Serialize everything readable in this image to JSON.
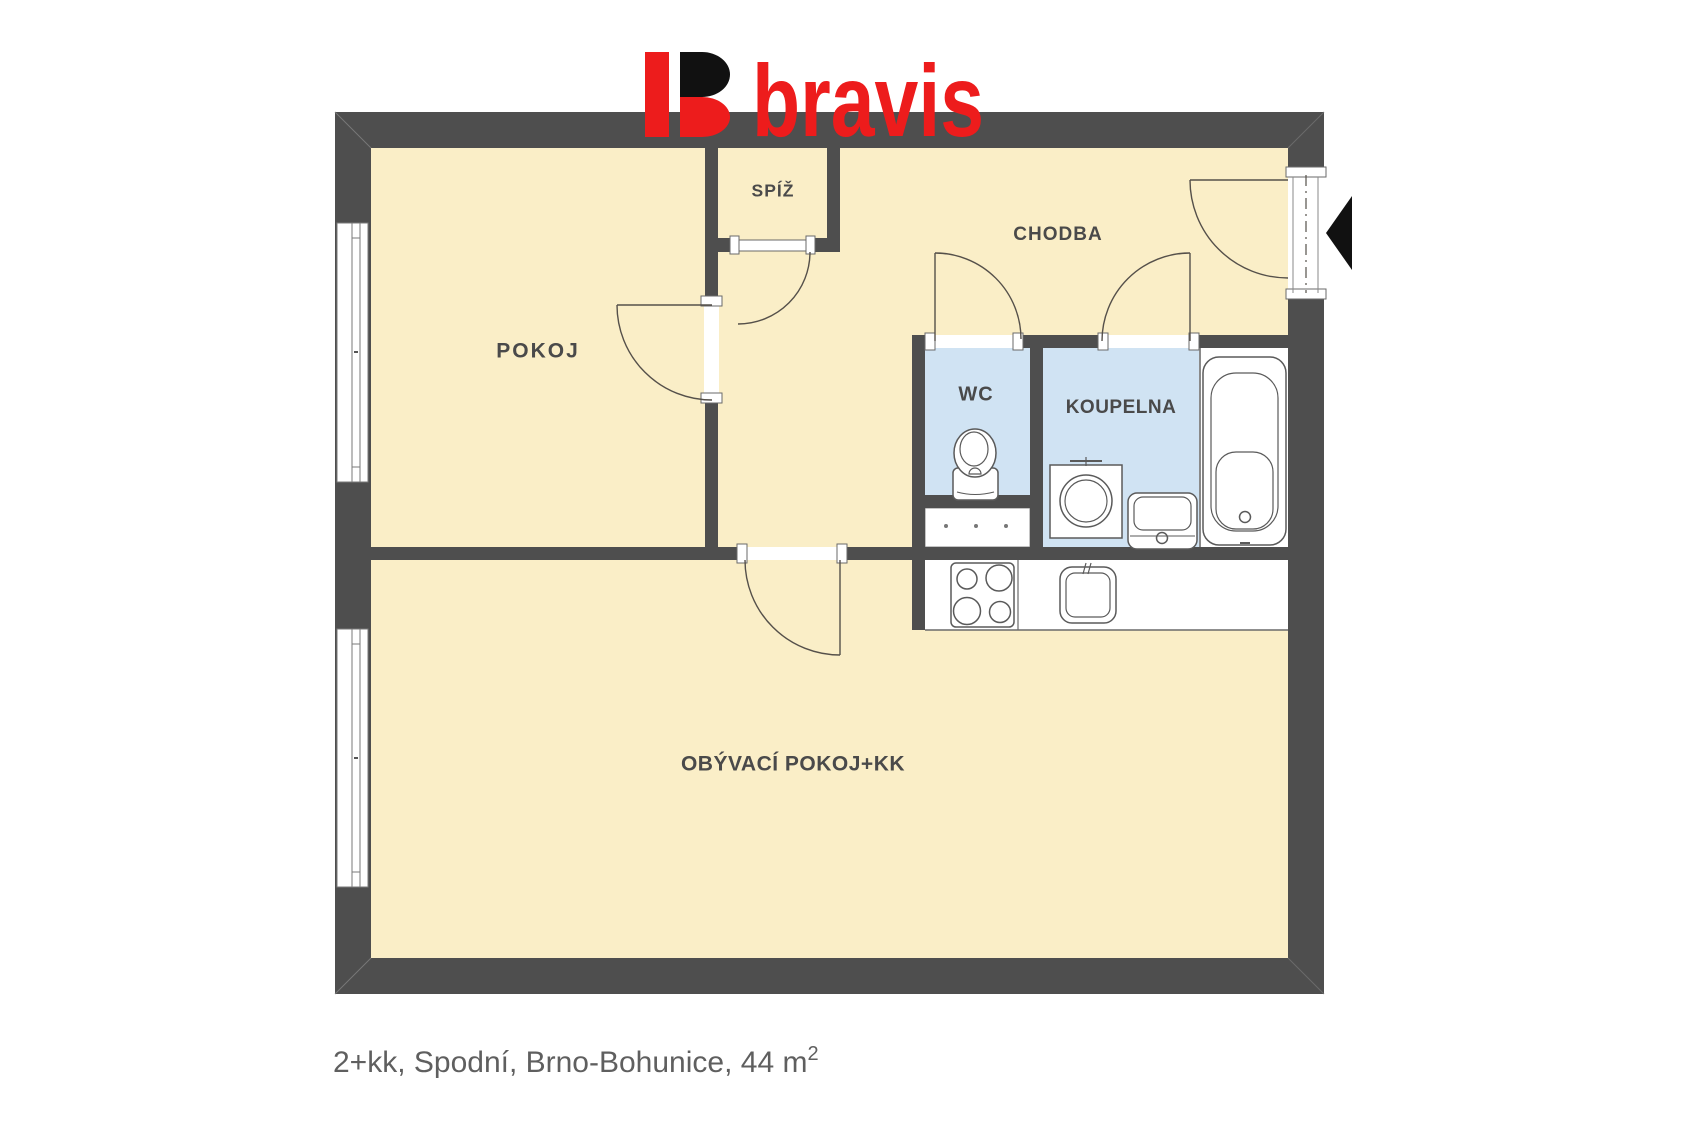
{
  "logo": {
    "brand": "bravis",
    "mark": "split-b-logo-mark",
    "accent_color": "#ed1c1c",
    "mark_black": "#111111"
  },
  "rooms": {
    "pokoj": {
      "label": "POKOJ"
    },
    "spiz": {
      "label": "SPÍŽ"
    },
    "chodba": {
      "label": "CHODBA"
    },
    "wc": {
      "label": "WC"
    },
    "koupelna": {
      "label": "KOUPELNA"
    },
    "obyvaci": {
      "label": "OBÝVACÍ POKOJ+KK"
    }
  },
  "caption": {
    "main": "2+kk, Spodní, Brno-Bohunice, 44 m",
    "sup": "2"
  },
  "colors": {
    "wall": "#4e4e4e",
    "floor": "#faeec7",
    "wet_floor": "#d0e3f3",
    "outline": "#4f4a45",
    "label_text": "#4a4a4a",
    "caption_text": "#5f5f5f"
  },
  "fixtures": [
    "toilet",
    "washing-machine",
    "bathroom-sink",
    "bathtub",
    "cooktop",
    "kitchen-sink",
    "kitchen-counter",
    "vent-shaft"
  ],
  "entry": {
    "arrow": "entrance-arrow-left"
  }
}
